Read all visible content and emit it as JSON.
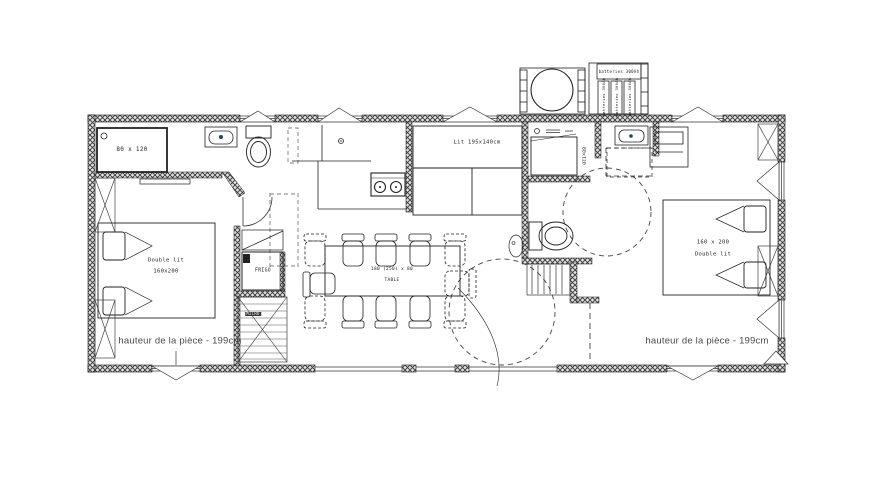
{
  "plan": {
    "rooms": {
      "bathroom_left": {
        "shower_label": "80 x 120"
      },
      "bedroom_left": {
        "bed_type": "Double lit",
        "bed_size": "160x200"
      },
      "kitchen": {
        "fridge_label": "FRIGO",
        "micro_label": "MICRO"
      },
      "bunk_room": {
        "bed_label": "Lit 195x140cm"
      },
      "dining": {
        "table_size": "180 (250) x 80",
        "table_label": "TABLE"
      },
      "bathroom_right": {
        "shower_label": "80x120"
      },
      "bedroom_right": {
        "bed_size": "160 x 200",
        "bed_type": "Double lit"
      }
    },
    "notes": {
      "height_left": "hauteur de la pièce - 199cm",
      "height_right": "hauteur de la pièce - 199cm"
    },
    "exterior": {
      "battery_bank_label": "batteries 300Ah",
      "battery_1": "batteries 300Ah",
      "battery_2": "batteries 300Ah",
      "battery_3": "batteries 300Ah"
    },
    "colors": {
      "line": "#222222",
      "hatch": "#383838",
      "note_text": "#4a4a4a",
      "faucet_dot": "#2b3e66"
    }
  }
}
